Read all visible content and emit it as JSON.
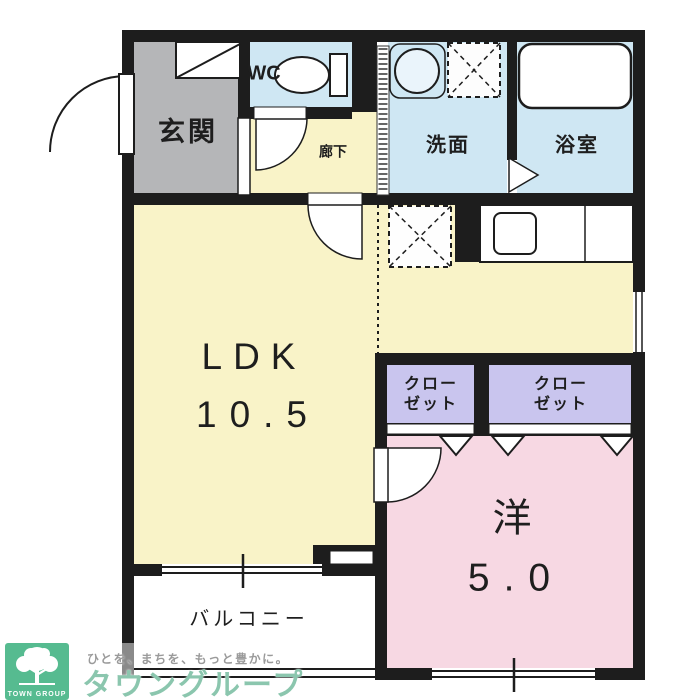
{
  "plan": {
    "rooms": {
      "genkan": {
        "label": "玄関"
      },
      "wc": {
        "label": "WC"
      },
      "hallway": {
        "label": "廊下"
      },
      "washroom": {
        "label": "洗面"
      },
      "bathroom": {
        "label": "浴室"
      },
      "ldk": {
        "label": "LDK",
        "size": "10.5"
      },
      "closet1": {
        "line1": "クロー",
        "line2": "ゼット"
      },
      "closet2": {
        "line1": "クロー",
        "line2": "ゼット"
      },
      "western": {
        "label": "洋",
        "size": "5.0"
      },
      "balcony": {
        "label": "バルコニー"
      }
    },
    "icons": [
      "entrance-door-swing-icon",
      "shoe-cabinet-icon",
      "toilet-icon",
      "sink-icon",
      "washing-machine-icon",
      "bathtub-icon",
      "folding-door-icon",
      "refrigerator-icon",
      "kitchen-counter-icon",
      "kitchen-sink-icon",
      "door-swing-icon",
      "bifold-door-icon",
      "sliding-window-icon",
      "tree-icon"
    ],
    "colors": {
      "wall": "#1d1d1d",
      "genkan_floor": "#b5b6b8",
      "wet_room_floor": "#cfe7f3",
      "flooring": "#f9f3c8",
      "closet_floor": "#c9c5ee",
      "bedroom_floor": "#f7d8e3"
    }
  },
  "branding": {
    "logo_title": "TOWN GROUP",
    "tagline": "ひとを、まちを、もっと豊かに。",
    "company": "タウングループ",
    "logo_green": "#56bb90",
    "company_green": "#8bc6ae",
    "tagline_gray": "#9a9a9a"
  }
}
